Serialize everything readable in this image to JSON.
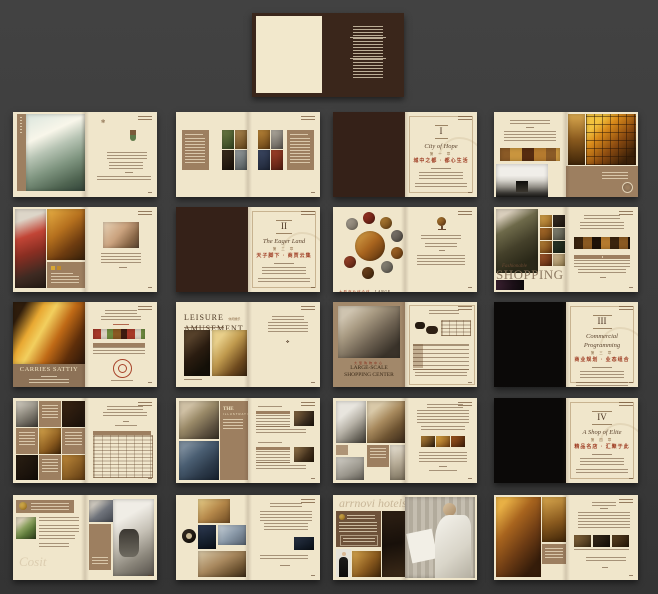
{
  "canvas": {
    "width": 658,
    "height": 594,
    "background": "#3c3c3c"
  },
  "palette": {
    "cream": "#f0e6cb",
    "dark_brown": "#352118",
    "black_page": "#0b0908",
    "taupe": "#9d7f60",
    "band_taupe": "#8d7257",
    "accent_red": "#9e3b22",
    "gold": "#d9a834"
  },
  "brand": {
    "watermark": "arrnovi hotels",
    "watermark_2": "Cosit"
  },
  "chapters": [
    {
      "numeral": "I",
      "title_script": "City of Hope",
      "chapter_cn": "第 一 章",
      "title_cn": "城中之都 · 都心生活"
    },
    {
      "numeral": "II",
      "title_script": "The Eager Land",
      "chapter_cn": "第 二 章",
      "title_cn": "天子脚下 · 商贾云集"
    },
    {
      "numeral": "III",
      "title_script": "Commercial Programming",
      "chapter_cn": "第 三 章",
      "title_cn": "商业规划 · 业态组合"
    },
    {
      "numeral": "IV",
      "title_script": "A Shop of Elite",
      "chapter_cn": "第 四 章",
      "title_cn": "精品名店 · 汇聚于此"
    }
  ],
  "headlines": {
    "fashionable": "Fashionable",
    "shopping": "SHOPPING",
    "leisure_1": "LEISURE",
    "leisure_2": "AMUSEMENT",
    "leisure_cn": "休闲娱乐",
    "carries": "CARRIES SATTIY",
    "largescale_cn": "大型购物中心",
    "largescale_1": "LARGE-SCALE",
    "largescale_2": "SHOPPING CENTER",
    "complex_cn": "大型商业综合体",
    "complex_en": "LARGE COMMERCIAL COMPLEX",
    "illustration_1": "THE",
    "illustration_2": "ILLUSTRATION"
  }
}
